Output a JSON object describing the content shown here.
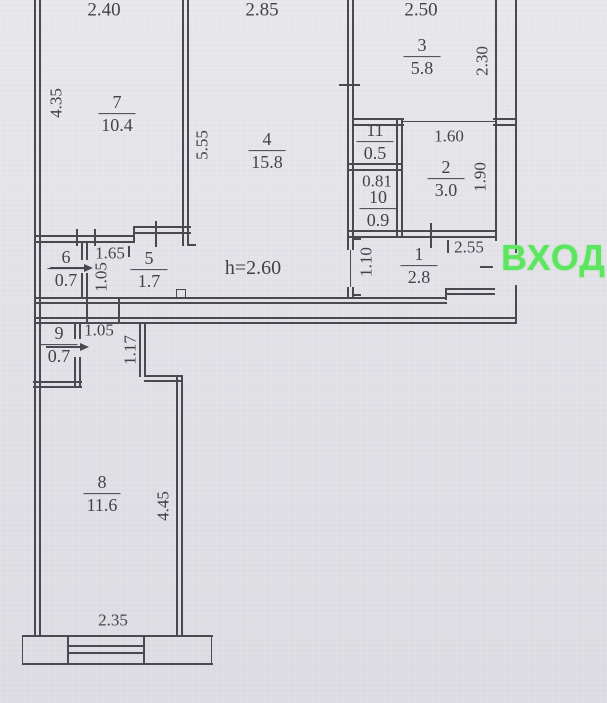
{
  "entrance": {
    "label": "ВХОД"
  },
  "ceiling": {
    "label": "h=2.60"
  },
  "rooms": [
    {
      "number": "7",
      "area": "10.4"
    },
    {
      "number": "4",
      "area": "15.8"
    },
    {
      "number": "3",
      "area": "5.8"
    },
    {
      "number": "11",
      "area": "0.5"
    },
    {
      "number": "10",
      "area": "0.9"
    },
    {
      "number": "2",
      "area": "3.0"
    },
    {
      "number": "6",
      "area": "0.7"
    },
    {
      "number": "5",
      "area": "1.7"
    },
    {
      "number": "1",
      "area": "2.8"
    },
    {
      "number": "9",
      "area": "0.7"
    },
    {
      "number": "8",
      "area": "11.6"
    }
  ],
  "dimensions": {
    "room7_width": "2.40",
    "room4_width": "2.85",
    "room3_width": "2.50",
    "room7_height": "4.35",
    "room4_height": "5.55",
    "room3_height": "2.30",
    "room2_width": "1.60",
    "room2_height": "1.90",
    "room10_width": "0.81",
    "hall_width": "1.65",
    "hall_depth": "1.05",
    "room1_width": "2.55",
    "room1_opening": "1.10",
    "passage_width": "1.05",
    "passage_depth": "1.17",
    "room8_height": "4.45",
    "room8_window_width": "2.35"
  },
  "colors": {
    "paper": "#e2e1e6",
    "line": "#4a4950",
    "text": "#434249",
    "entrance_green": "#5ce65f"
  }
}
